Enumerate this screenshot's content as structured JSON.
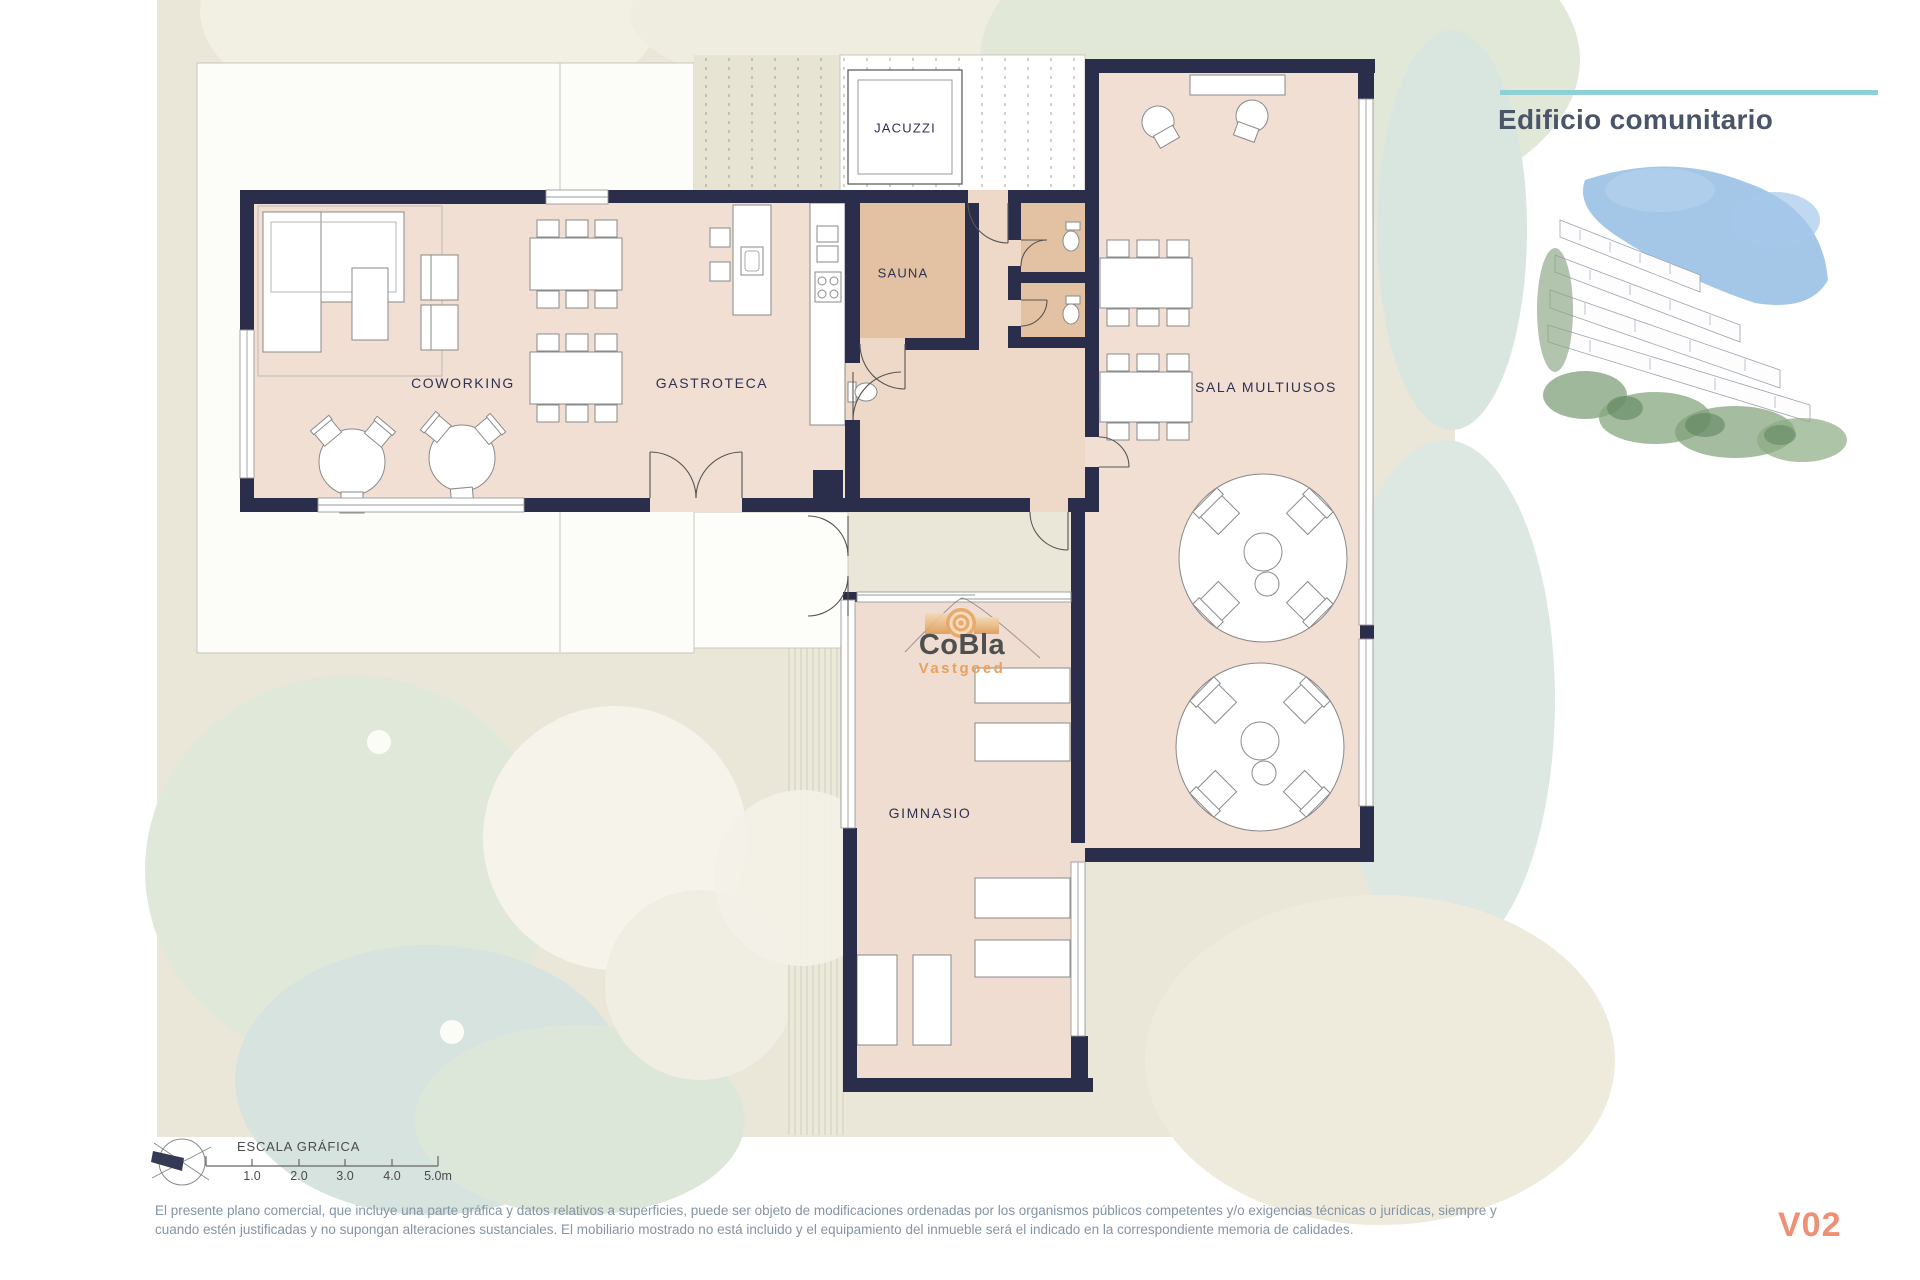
{
  "header": {
    "title": "Edificio comunitario"
  },
  "plan": {
    "rooms": {
      "jacuzzi": "JACUZZI",
      "sauna": "SAUNA",
      "coworking": "COWORKING",
      "gastroteca": "GASTROTECA",
      "sala_multiusos": "SALA MULTIUSOS",
      "gimnasio": "GIMNASIO"
    },
    "watermark": {
      "line1": "CoBla",
      "line2": "Vastgoed"
    }
  },
  "scale_bar": {
    "label": "ESCALA GRÁFICA",
    "ticks": [
      "1.0",
      "2.0",
      "3.0",
      "4.0",
      "5.0m"
    ]
  },
  "footer": {
    "disclaimer_line1": "El presente plano comercial, que incluye una parte gráfica y datos relativos a superficies, puede ser objeto de modificaciones ordenadas por los organismos públicos competentes y/o exigencias técnicas o jurídicas, siempre y",
    "disclaimer_line2": "cuando estén justificadas y no supongan alteraciones sustanciales. El mobiliario mostrado no está incluido y el equipamiento del inmueble será el indicado en la correspondiente memoria de calidades.",
    "version": "V02"
  },
  "colors": {
    "wall": "#2a2e4a",
    "floor": "#f2dfd3",
    "warm_room": "#e2c2a2",
    "accent_teal": "#8ed0d6",
    "version_coral": "#ef8f76",
    "logo_orange": "#e6a160",
    "title_gray": "#4a5568",
    "disclaimer_gray": "#8494a4"
  }
}
